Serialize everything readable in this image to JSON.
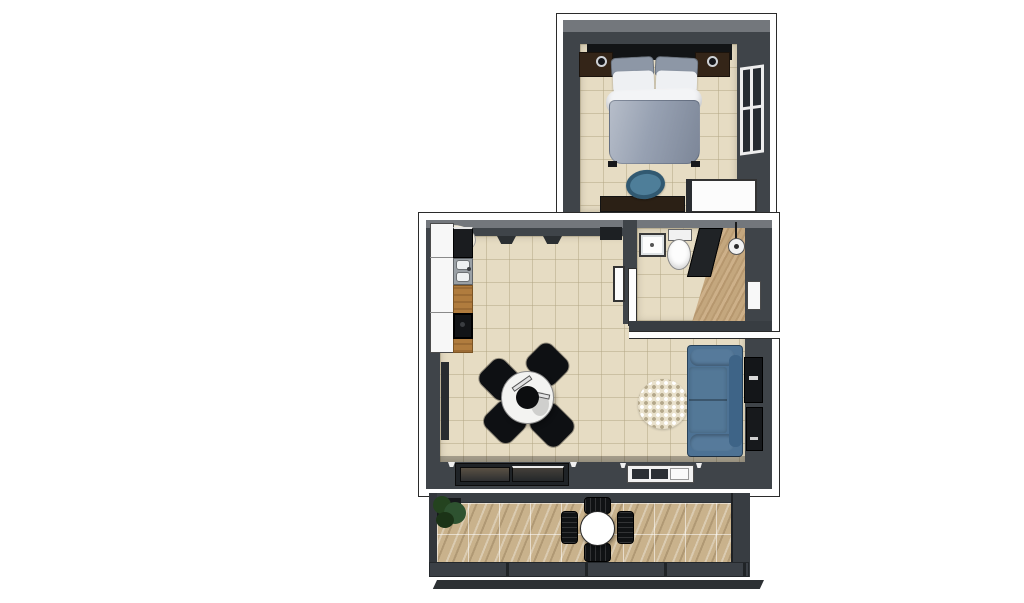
{
  "scene": {
    "description": "3D top-down rendered floor plan of a one-bedroom apartment with open living/kitchen area, bathroom, bedroom unit and balcony",
    "render_style": "axonometric cutaway render, no text labels",
    "canvas": {
      "width": 1024,
      "height": 603
    }
  },
  "palette": {
    "canvas_bg": "#ffffff",
    "wall_dark": "#3f4449",
    "wall_top_light": "#73777c",
    "wall_cut_white": "#fdfdfd",
    "floor_tile_beige": "#e6dcc3",
    "balcony_stone": "#c9b28c",
    "counter_wood": "#b07c3e",
    "sofa_blue": "#4d7294",
    "duvet_gray_blue": "#97a1b2",
    "office_chair_blue": "#4e7e99",
    "furniture_black": "#121416",
    "furniture_dark_brown": "#342518",
    "fixture_white": "#f7f7f7",
    "plant_green": "#2e5230",
    "glass_dark": "#2b2f34"
  },
  "rooms": {
    "bedroom": {
      "name": "bedroom",
      "furniture": [
        "headboard",
        "nightstand-left",
        "wall-lamp-left",
        "nightstand-right",
        "wall-lamp-right",
        "double-bed-with-pillows-and-duvet",
        "window-right-wall",
        "desk",
        "desk-chair",
        "wardrobe"
      ]
    },
    "living_kitchen": {
      "name": "living-kitchen",
      "furniture": [
        "kitchen-cabinets",
        "fridge-appliance",
        "double-sink",
        "wood-countertop",
        "cooktop",
        "round-dining-table",
        "pendant-lamp",
        "dining-chairs-x4",
        "round-dotted-rug",
        "sofa",
        "media-wall-unit",
        "sliding-glass-door",
        "window-bottom-wall",
        "entry-door-opening"
      ]
    },
    "bathroom": {
      "name": "bathroom",
      "furniture": [
        "washbasin",
        "toilet",
        "shower-partition",
        "shower-head",
        "towel-radiator",
        "teak-shower-floor",
        "door-panel"
      ]
    },
    "balcony": {
      "name": "balcony",
      "furniture": [
        "potted-plant",
        "round-bistro-table",
        "outdoor-chairs-x4",
        "railing"
      ]
    }
  }
}
